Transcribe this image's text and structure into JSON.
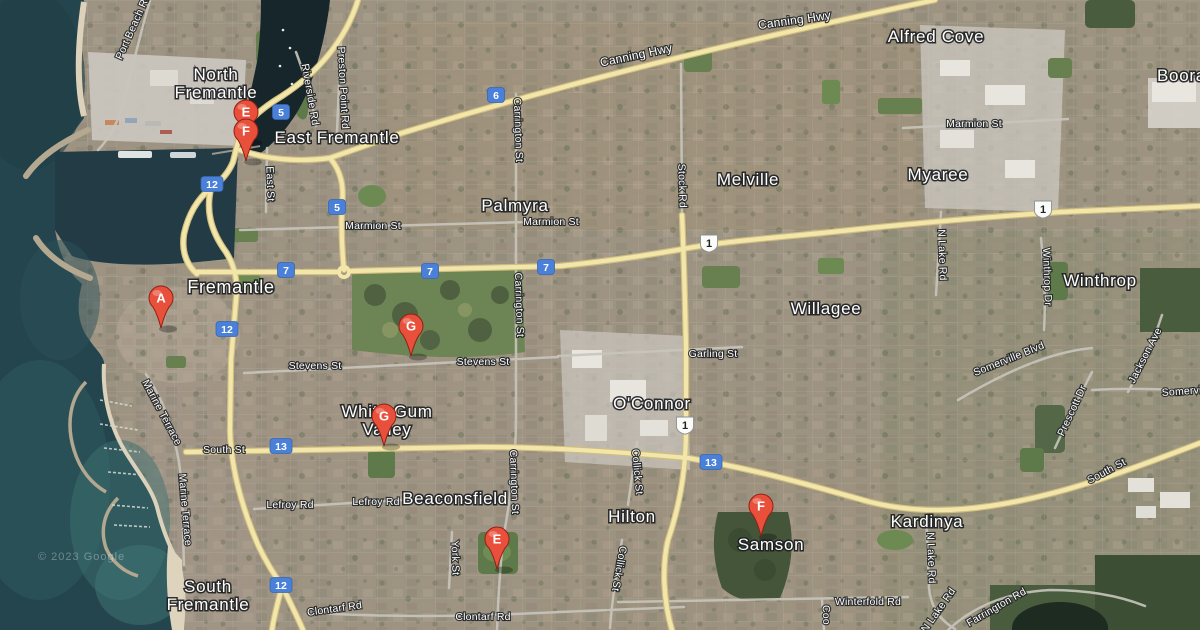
{
  "map": {
    "description": "Satellite map of Fremantle and surrounding suburbs with lettered place markers",
    "attribution": "© 2023 Google",
    "colors": {
      "marker_red": "#e8503c",
      "marker_border": "#8f2015",
      "shield_blue": "#4a80d8",
      "shield_white": "#fbfbf8",
      "road_yellow": "#f2e6ab",
      "water_deep": "#24454d",
      "park_green": "#68804f",
      "sand": "#dcd2bc"
    }
  },
  "place_labels": [
    {
      "text": "North\nFremantle",
      "x": 216,
      "y": 80
    },
    {
      "text": "East Fremantle",
      "x": 337,
      "y": 143
    },
    {
      "text": "Fremantle",
      "x": 231,
      "y": 293,
      "size": 18
    },
    {
      "text": "Palmyra",
      "x": 515,
      "y": 211
    },
    {
      "text": "Melville",
      "x": 748,
      "y": 185
    },
    {
      "text": "Myaree",
      "x": 938,
      "y": 180
    },
    {
      "text": "Alfred Cove",
      "x": 936,
      "y": 42
    },
    {
      "text": "Booragoon",
      "x": 1157,
      "y": 81,
      "anchor": "start"
    },
    {
      "text": "Winthrop",
      "x": 1100,
      "y": 286
    },
    {
      "text": "Willagee",
      "x": 826,
      "y": 314
    },
    {
      "text": "O'Connor",
      "x": 652,
      "y": 409
    },
    {
      "text": "Hilton",
      "x": 632,
      "y": 522
    },
    {
      "text": "Beaconsfield",
      "x": 455,
      "y": 504
    },
    {
      "text": "White Gum\nValley",
      "x": 387,
      "y": 417
    },
    {
      "text": "South\nFremantle",
      "x": 208,
      "y": 592
    },
    {
      "text": "Samson",
      "x": 771,
      "y": 550
    },
    {
      "text": "Kardinya",
      "x": 927,
      "y": 527
    }
  ],
  "road_labels": [
    {
      "text": "Canning Hwy",
      "x": 637,
      "y": 59,
      "rotate": -12,
      "size": 12
    },
    {
      "text": "Canning Hwy",
      "x": 795,
      "y": 24,
      "rotate": -8,
      "size": 12
    },
    {
      "text": "Port Beach Rd",
      "x": 136,
      "y": 28,
      "rotate": -66
    },
    {
      "text": "Riverside Rd",
      "x": 307,
      "y": 95,
      "rotate": 80
    },
    {
      "text": "Preston Point Rd",
      "x": 340,
      "y": 88,
      "rotate": 87
    },
    {
      "text": "East St",
      "x": 267,
      "y": 184,
      "rotate": 88
    },
    {
      "text": "Marmion St",
      "x": 373,
      "y": 229
    },
    {
      "text": "Marmion St",
      "x": 551,
      "y": 225
    },
    {
      "text": "Marmion St",
      "x": 974,
      "y": 127
    },
    {
      "text": "Carrington St",
      "x": 515,
      "y": 130,
      "rotate": 88
    },
    {
      "text": "Carrington St",
      "x": 516,
      "y": 305,
      "rotate": 88
    },
    {
      "text": "Carrington St",
      "x": 511,
      "y": 482,
      "rotate": 88
    },
    {
      "text": "Stock Rd",
      "x": 679,
      "y": 186,
      "rotate": 88
    },
    {
      "text": "Stevens St",
      "x": 315,
      "y": 369
    },
    {
      "text": "Stevens St",
      "x": 483,
      "y": 365
    },
    {
      "text": "Garling St",
      "x": 713,
      "y": 357
    },
    {
      "text": "South St",
      "x": 224,
      "y": 453
    },
    {
      "text": "South St",
      "x": 1108,
      "y": 474,
      "rotate": -28
    },
    {
      "text": "Lefroy Rd",
      "x": 290,
      "y": 508
    },
    {
      "text": "Lefroy Rd",
      "x": 376,
      "y": 505
    },
    {
      "text": "Marine Terrace",
      "x": 159,
      "y": 414,
      "rotate": 62
    },
    {
      "text": "Marine Terrace",
      "x": 182,
      "y": 510,
      "rotate": 85
    },
    {
      "text": "York St",
      "x": 452,
      "y": 558,
      "rotate": 88
    },
    {
      "text": "Collick St",
      "x": 634,
      "y": 472,
      "rotate": 85
    },
    {
      "text": "Collick St",
      "x": 616,
      "y": 568,
      "rotate": 100
    },
    {
      "text": "Clontarf Rd",
      "x": 335,
      "y": 612,
      "rotate": -8
    },
    {
      "text": "Clontarf Rd",
      "x": 483,
      "y": 620
    },
    {
      "text": "Winterfold Rd",
      "x": 868,
      "y": 605
    },
    {
      "text": "N Lake Rd",
      "x": 939,
      "y": 255,
      "rotate": 88
    },
    {
      "text": "N Lake Rd",
      "x": 928,
      "y": 558,
      "rotate": 88
    },
    {
      "text": "N Lake Rd",
      "x": 941,
      "y": 612,
      "rotate": -55
    },
    {
      "text": "Winthrop Dr",
      "x": 1044,
      "y": 277,
      "rotate": 88
    },
    {
      "text": "Somerville Blvd",
      "x": 1010,
      "y": 362,
      "rotate": -22
    },
    {
      "text": "Somerville Blvd",
      "x": 1162,
      "y": 396,
      "rotate": -4,
      "anchor": "start"
    },
    {
      "text": "Jackson Ave",
      "x": 1148,
      "y": 357,
      "rotate": -63
    },
    {
      "text": "Prescott Dr",
      "x": 1075,
      "y": 412,
      "rotate": -65
    },
    {
      "text": "Farrington Rd",
      "x": 998,
      "y": 610,
      "rotate": -30
    },
    {
      "text": "Coo",
      "x": 823,
      "y": 615,
      "rotate": 88
    }
  ],
  "route_shields": [
    {
      "number": "5",
      "x": 281,
      "y": 112,
      "style": "state"
    },
    {
      "number": "5",
      "x": 337,
      "y": 207,
      "style": "state"
    },
    {
      "number": "6",
      "x": 496,
      "y": 95,
      "style": "state"
    },
    {
      "number": "7",
      "x": 286,
      "y": 270,
      "style": "state"
    },
    {
      "number": "7",
      "x": 430,
      "y": 271,
      "style": "state"
    },
    {
      "number": "7",
      "x": 546,
      "y": 267,
      "style": "state"
    },
    {
      "number": "12",
      "x": 212,
      "y": 184,
      "style": "state"
    },
    {
      "number": "12",
      "x": 227,
      "y": 329,
      "style": "state"
    },
    {
      "number": "12",
      "x": 281,
      "y": 585,
      "style": "state"
    },
    {
      "number": "13",
      "x": 281,
      "y": 446,
      "style": "state"
    },
    {
      "number": "13",
      "x": 711,
      "y": 462,
      "style": "state"
    },
    {
      "number": "1",
      "x": 709,
      "y": 243,
      "style": "national"
    },
    {
      "number": "1",
      "x": 1043,
      "y": 209,
      "style": "national"
    },
    {
      "number": "1",
      "x": 685,
      "y": 425,
      "style": "national"
    }
  ],
  "markers": [
    {
      "letter": "E",
      "x": 246,
      "y": 112
    },
    {
      "letter": "F",
      "x": 246,
      "y": 131
    },
    {
      "letter": "A",
      "x": 161,
      "y": 298
    },
    {
      "letter": "G",
      "x": 411,
      "y": 326
    },
    {
      "letter": "G",
      "x": 384,
      "y": 416
    },
    {
      "letter": "E",
      "x": 497,
      "y": 539
    },
    {
      "letter": "F",
      "x": 761,
      "y": 506
    }
  ]
}
